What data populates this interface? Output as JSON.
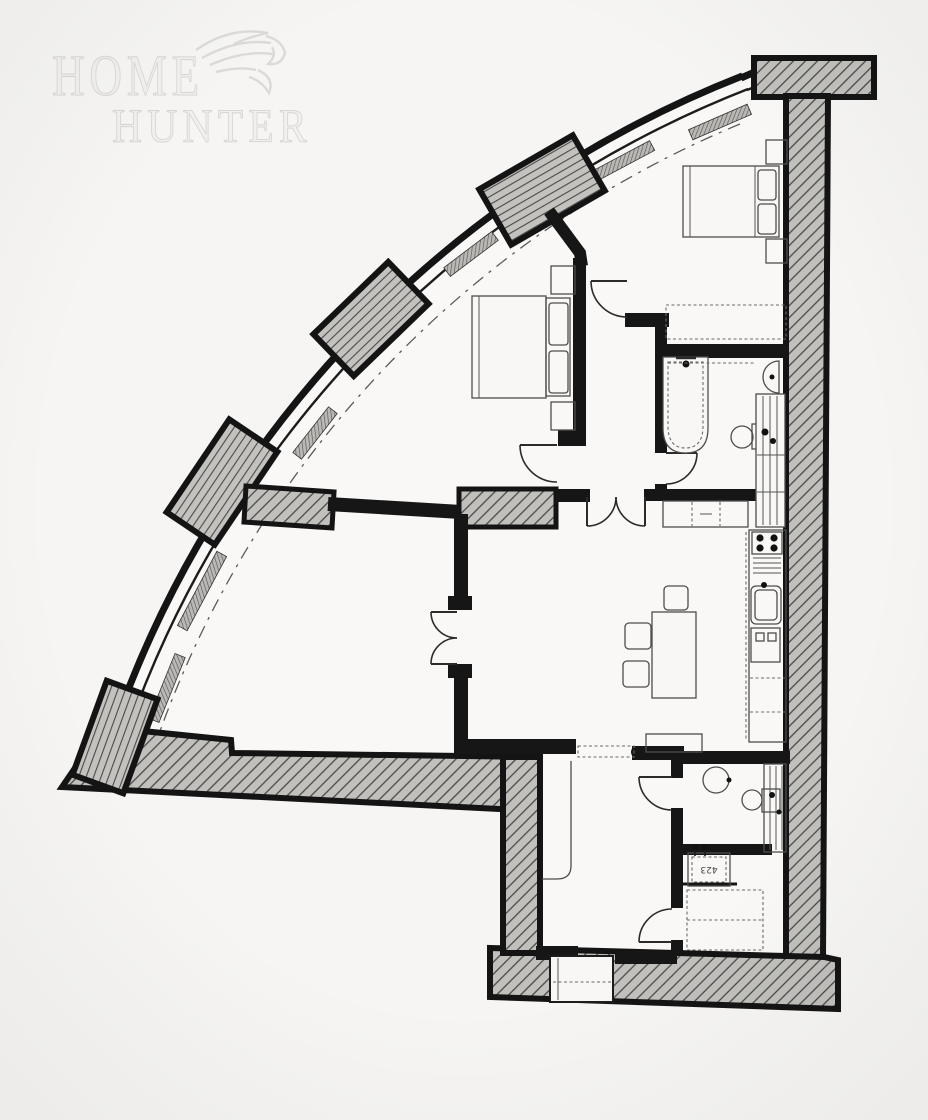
{
  "watermark": {
    "line1": "Home",
    "line2": "Hunter",
    "logo": "eagle-logo"
  },
  "labels": {
    "shower_dimension": "423"
  },
  "colors": {
    "paper": "#f6f5f3",
    "floor": "#f9f8f6",
    "ink": "#161616",
    "hatch_background": "#c1c0bd",
    "hatch_line": "#4b4a48",
    "furniture_line": "#4d4d4c",
    "watermark": "#e9e8e5"
  },
  "plan": {
    "type": "apartment floor plan (scanned, black and white)",
    "features": [
      "curved glazed facade with hatched mullion piers and radiator strips",
      "thick hatched structural wall on right with T-shaped cap",
      "hatched bottom wall with entrance recess",
      "bedroom top-right with double bed and bedside tables",
      "bedroom middle with double bed, pillows and bedside tables",
      "en-suite bathroom with bathtub, basin, wc and shelved duct",
      "inner hallway with single doors and double doors",
      "open living-dining room with table, chairs and sideboard",
      "kitchen run along right wall with hob, sink and oven",
      "large fan-shaped lounge with double doors",
      "entrance lobby with built-in closet",
      "second bathroom with round basin and wc",
      "shower room with labelled shower tray",
      "utility room with dashed wardrobe"
    ]
  }
}
